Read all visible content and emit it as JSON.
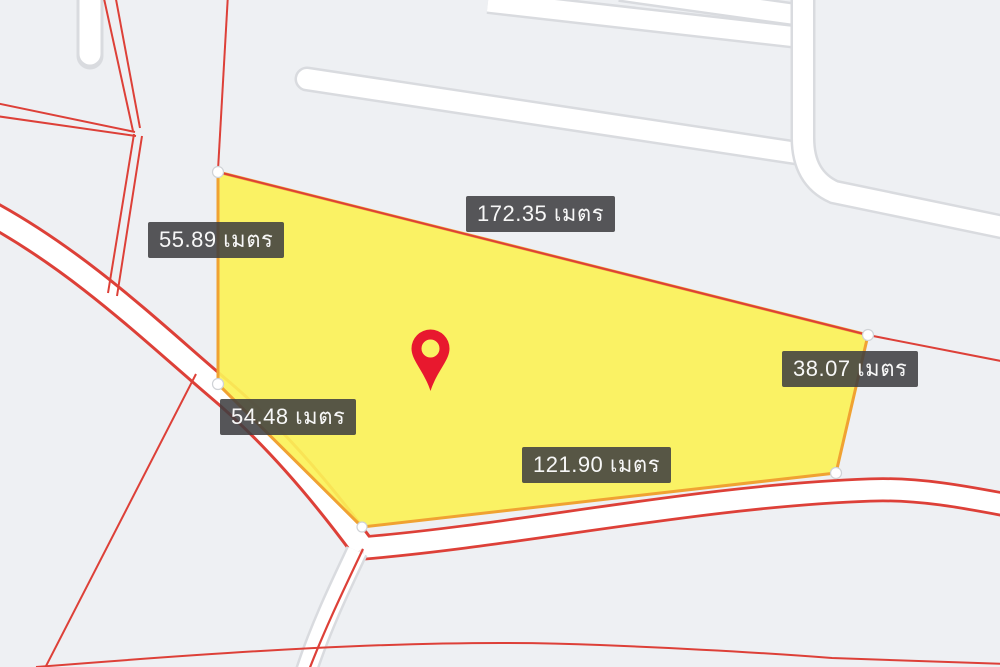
{
  "app": {
    "name": "land-parcel-map-view"
  },
  "map": {
    "background_color": "#eef0f3",
    "road_fill_color": "#ffffff",
    "road_casing_color": "#d9dbdf",
    "boundary_line_color": "#dd4038",
    "parcel": {
      "fill_color": "#fbf258",
      "border_color": "#f0a232",
      "unit": "เมตร",
      "measurements": [
        {
          "side": "left-upper",
          "text": "55.89 เมตร"
        },
        {
          "side": "top",
          "text": "172.35 เมตร"
        },
        {
          "side": "right",
          "text": "38.07 เมตร"
        },
        {
          "side": "left-lower",
          "text": "54.48 เมตร"
        },
        {
          "side": "bottom",
          "text": "121.90 เมตร"
        }
      ]
    },
    "marker": {
      "type": "location-pin",
      "color": "#e8182e"
    },
    "label_style": {
      "background": "rgba(62,62,64,0.87)",
      "text_color": "#f7f7f7"
    }
  }
}
